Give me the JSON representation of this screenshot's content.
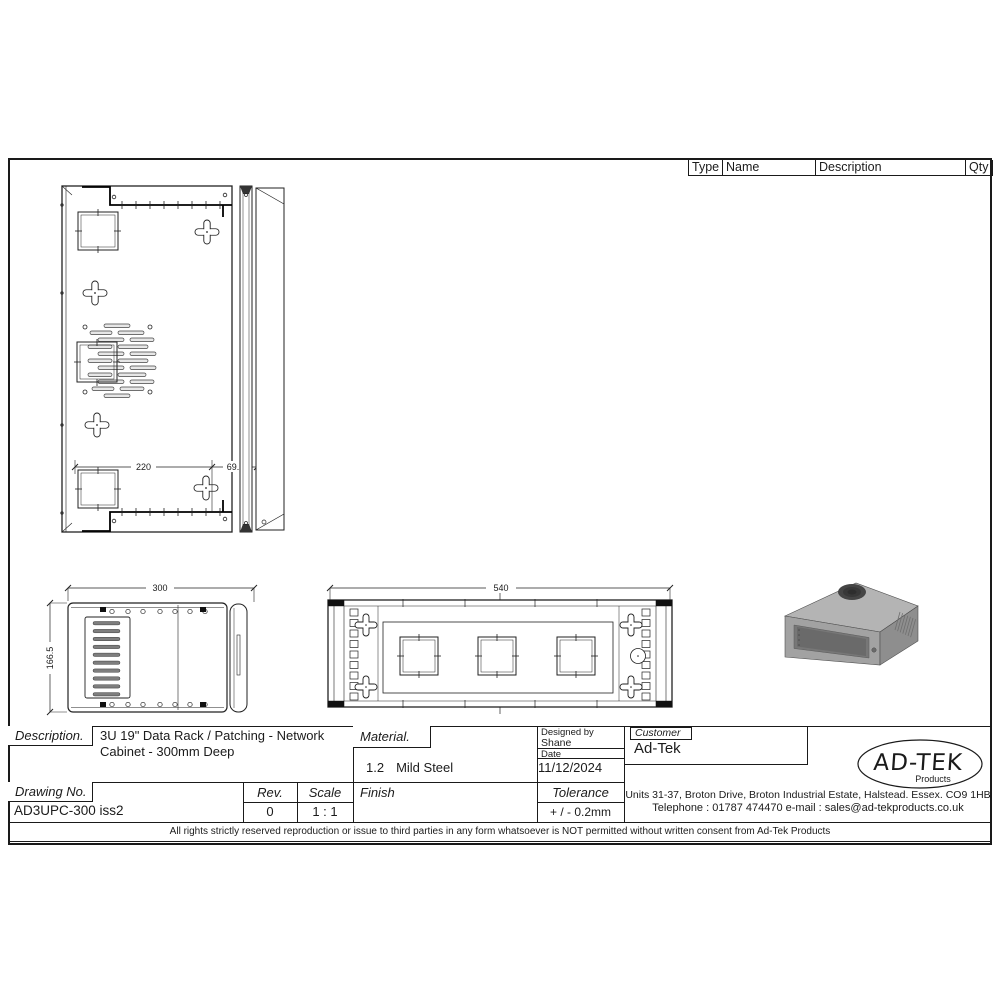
{
  "parts_table": {
    "headers": [
      "Type",
      "Name",
      "Description",
      "Qty"
    ]
  },
  "views": {
    "top": {
      "dim_width": "220",
      "dim_offset": "69.5"
    },
    "side": {
      "dim_depth": "300",
      "dim_height": "166.5"
    },
    "front": {
      "dim_width": "540"
    }
  },
  "title_block": {
    "description": {
      "label": "Description.",
      "line1": "3U 19\" Data Rack / Patching - Network",
      "line2": "Cabinet - 300mm Deep"
    },
    "drawing_no": {
      "label": "Drawing No.",
      "value": "AD3UPC-300 iss2"
    },
    "rev": {
      "label": "Rev.",
      "value": "0"
    },
    "scale": {
      "label": "Scale",
      "value": "1 : 1"
    },
    "material": {
      "label": "Material.",
      "thickness": "1.2",
      "value": "Mild Steel"
    },
    "finish": {
      "label": "Finish",
      "value": ""
    },
    "designed_by": {
      "label": "Designed by",
      "value": "Shane"
    },
    "date": {
      "label": "Date",
      "value": "11/12/2024"
    },
    "tolerance": {
      "label": "Tolerance",
      "value": "+ / - 0.2mm"
    },
    "customer": {
      "label": "Customer",
      "value": "Ad-Tek"
    },
    "logo": {
      "name": "AD-TEK",
      "tagline": "Products"
    },
    "address": {
      "line1": "Units 31-37, Broton Drive, Broton Industrial Estate, Halstead. Essex. CO9 1HB",
      "line2": "Telephone : 01787 474470  e-mail : sales@ad-tekproducts.co.uk"
    }
  },
  "footer": {
    "copyright": "All rights strictly reserved reproduction or issue to third parties in any form whatsoever is NOT permitted without written consent from Ad-Tek Products"
  },
  "colors": {
    "line": "#1a1a1a",
    "iso_top": "#b4b4b4",
    "iso_front": "#a2a2a2",
    "iso_side": "#8e8e8e",
    "iso_window": "#6a6a6a"
  }
}
